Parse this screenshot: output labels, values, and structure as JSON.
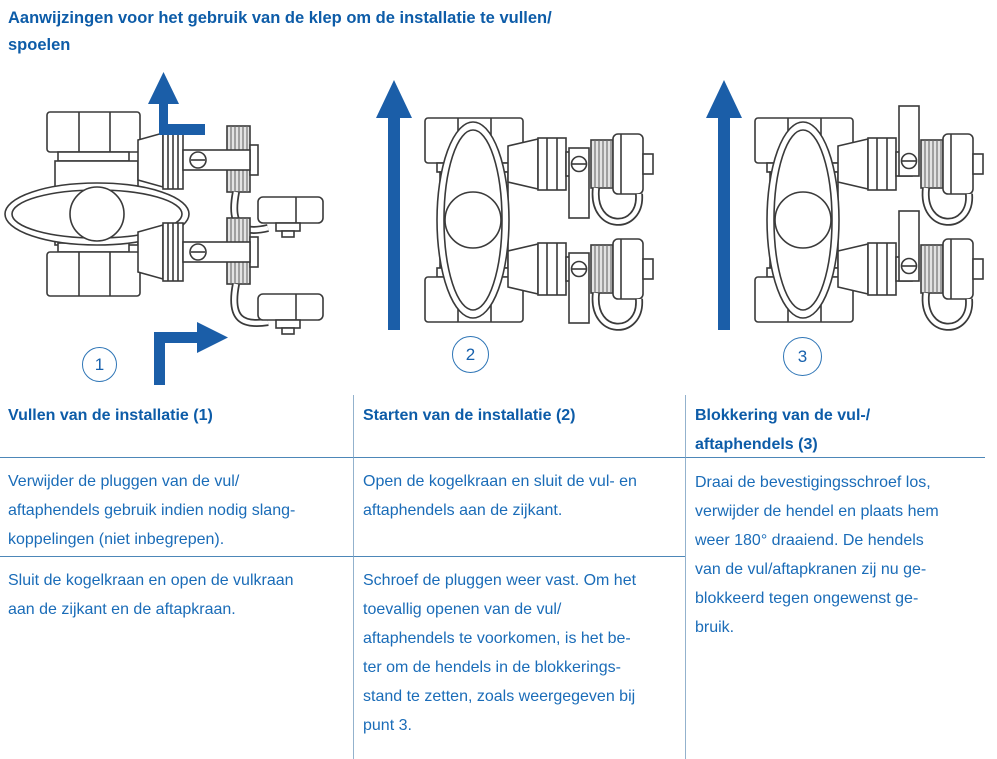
{
  "page_title": [
    "Aanwijzingen voor het gebruik van de klep om de installatie te vullen/",
    "spoelen"
  ],
  "figures": {
    "fig1_label": "1",
    "fig2_label": "2",
    "fig3_label": "3"
  },
  "table": {
    "header_col1": "Vullen van de installatie (1)",
    "header_col2": "Starten van de installatie (2)",
    "header_col3": [
      "Blokkering van de vul-/",
      "aftaphendels (3)"
    ],
    "col1_row1": [
      "Verwijder de pluggen van de vul/",
      "aftaphendels gebruik indien nodig slang-",
      "koppelingen (niet inbegrepen)."
    ],
    "col1_row2": [
      "Sluit de kogelkraan en open de vulkraan",
      "aan de zijkant en de aftapkraan."
    ],
    "col2_row1": [
      "Open de kogelkraan en sluit de vul- en",
      "aftaphendels aan de zijkant."
    ],
    "col2_row2": [
      "Schroef de pluggen weer vast. Om het",
      "toevallig openen van de vul/",
      "aftaphendels te voorkomen, is het be-",
      "ter om de hendels in de blokkerings-",
      "stand te zetten, zoals weergegeven bij",
      "punt 3."
    ],
    "col3": [
      "Draai de bevestigingsschroef los,",
      "verwijder de hendel en plaats hem",
      "weer 180° draaiend. De hendels",
      "van de vul/aftapkranen zij nu ge-",
      "blokkeerd tegen ongewenst ge-",
      "bruik."
    ]
  },
  "colors": {
    "heading_blue": "#0d5ca8",
    "body_blue": "#1a6cb8",
    "arrow_blue": "#1b5ea8",
    "table_line_horizontal": "#4d87b8",
    "table_line_vertical": "#93b2cd",
    "diagram_line": "#3a3a3a"
  }
}
